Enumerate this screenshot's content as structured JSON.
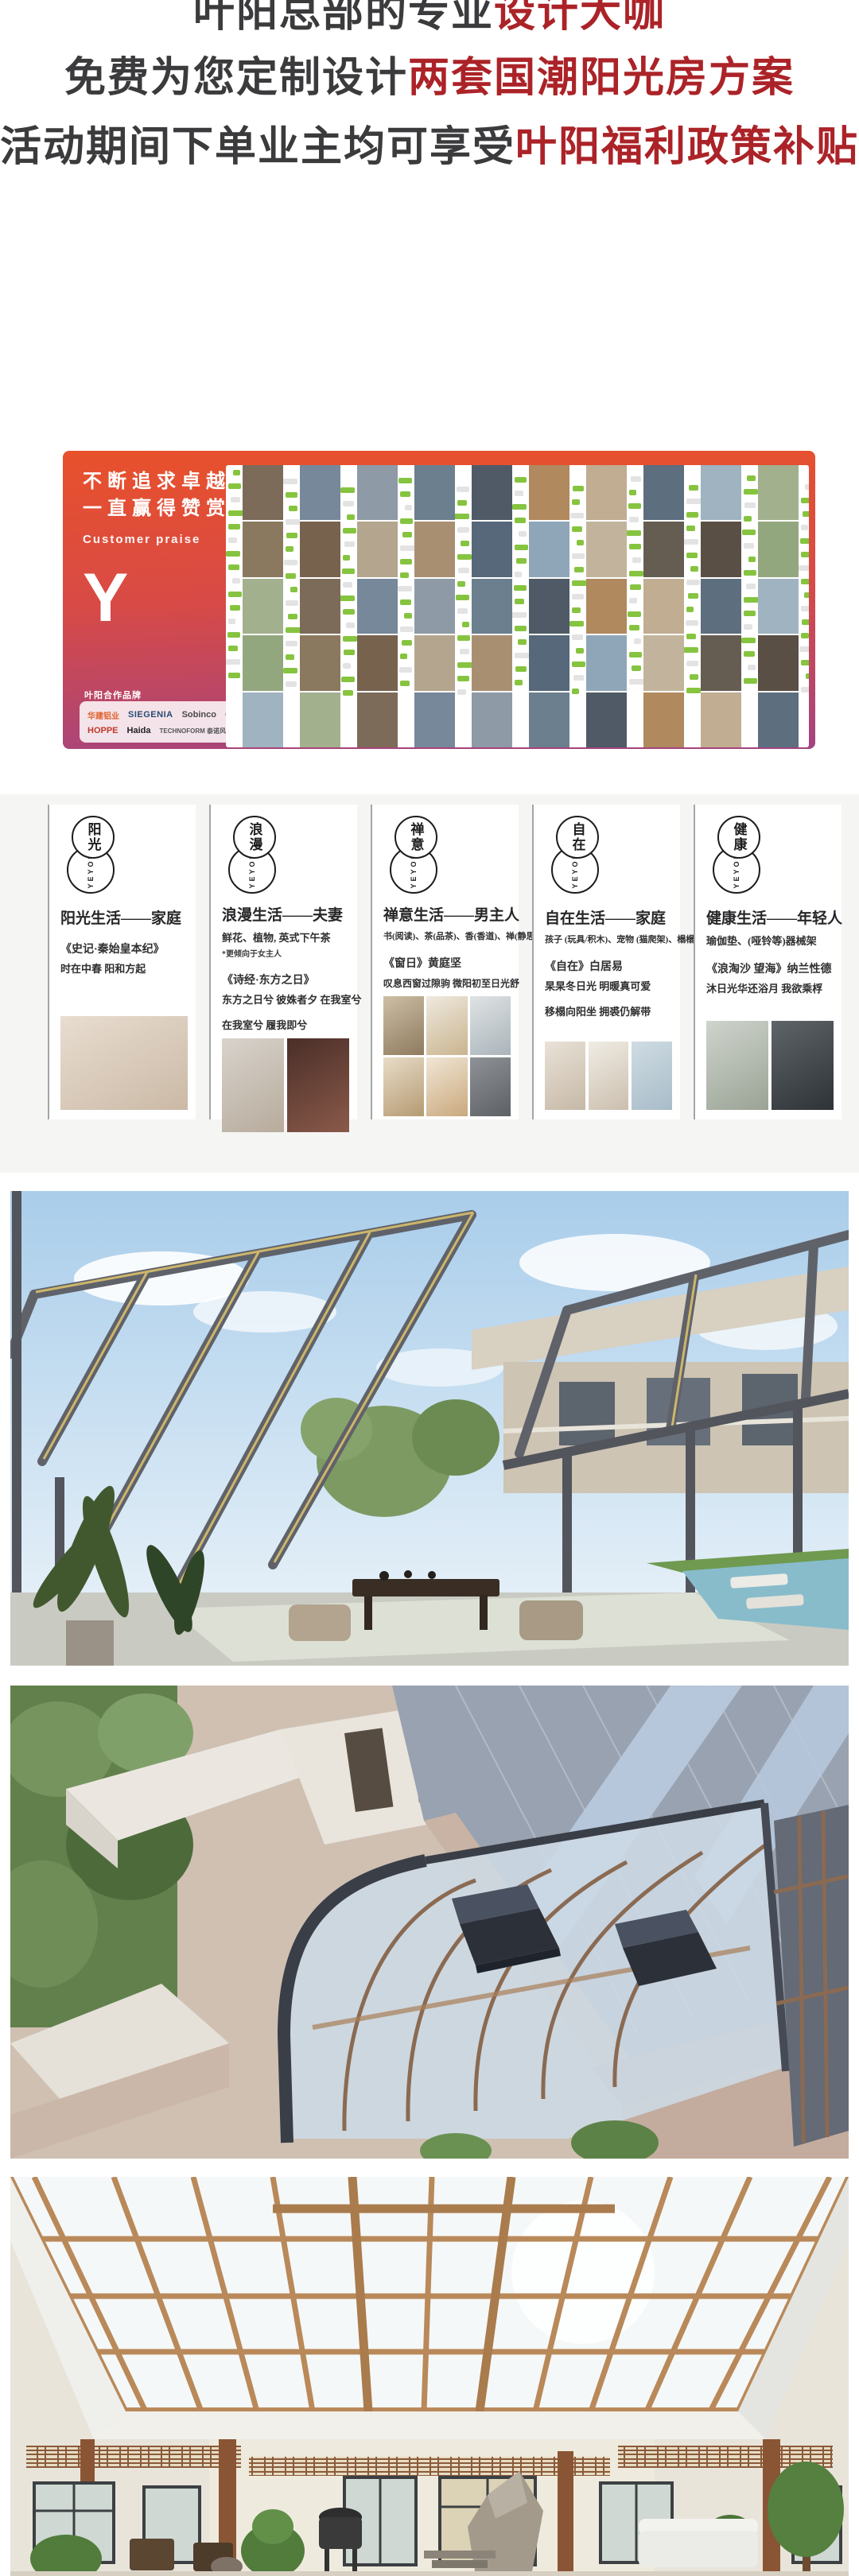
{
  "header": {
    "text_color": "#3b3b3d",
    "accent_color": "#ab2328",
    "lines": [
      {
        "black": "叶阳总部的专业",
        "red": "设计大咖"
      },
      {
        "black": "免费为您定制设计",
        "red": "两套国潮阳光房方案"
      },
      {
        "black": "活动期间下单业主均可享受",
        "red": "叶阳福利政策补贴"
      }
    ]
  },
  "banner": {
    "slogan_line1": "不断追求卓越",
    "slogan_line2": "一直赢得赞赏",
    "slogan_en": "Customer praise",
    "logo_letter": "Y",
    "partner_label": "叶阳合作品牌",
    "partner_brands": [
      "华建铝业",
      "SIEGENIA",
      "Sobinco",
      "CMECH",
      "HOPPE",
      "Haida",
      "TECHNOFORM 泰诺风"
    ],
    "gradient_top": "#e8512b",
    "gradient_bottom": "#a34480",
    "collage": {
      "columns": 21,
      "chat_rows": 16,
      "photo_rows": 5,
      "bubble_color": "#86c440",
      "tile_colors": [
        "#8fa6b8",
        "#6b7f8e",
        "#b4a58f",
        "#7d6b5a",
        "#93a77f",
        "#5d6e7e",
        "#c2b39c",
        "#4f5a66",
        "#a98f72",
        "#76889a",
        "#8a795f",
        "#9fb3c0",
        "#655d52",
        "#b0895e",
        "#56687a",
        "#8e9aa6",
        "#77624e",
        "#a3b08e",
        "#5a4f45",
        "#c0ad92"
      ]
    }
  },
  "cards": {
    "items": [
      {
        "logo_chars": "阳光",
        "logo_sub": "YEYON",
        "title": "阳光生活——家庭",
        "source": "《史记·秦始皇本纪》",
        "poem": [
          "时在中春 阳和方起"
        ],
        "photo_tiles": [
          [
            "#e8ddd0",
            "#cbb9a6"
          ]
        ]
      },
      {
        "logo_chars": "浪漫",
        "logo_sub": "YEYON",
        "title": "浪漫生活——夫妻",
        "subtitle": "鲜花、植物, 英式下午茶",
        "note": "*更倾向于女主人",
        "source": "《诗经·东方之日》",
        "poem": [
          "东方之日兮 彼姝者夕 在我室兮",
          "在我室兮 履我即兮"
        ],
        "photo_tiles": [
          [
            "#d8d3cc",
            "#b7ab9c"
          ],
          [
            "#4a2e28",
            "#8a5a4a"
          ]
        ]
      },
      {
        "logo_chars": "禅意",
        "logo_sub": "YEYON",
        "title": "禅意生活——男主人",
        "subtitle": "书(阅读)、茶(品茶)、香(香道)、禅(静思)",
        "source": "《窗日》黄庭坚",
        "poem": [
          "叹息西窗过隙驹 微阳初至日光舒"
        ],
        "photo_tiles": [
          [
            "#cdbfa5",
            "#8e7a5f"
          ],
          [
            "#efe9df",
            "#c9b48e"
          ],
          [
            "#dfe3e4",
            "#aab4ba"
          ],
          [
            "#e8dcc8",
            "#b59a72"
          ],
          [
            "#f0e6d6",
            "#caa87c"
          ],
          [
            "#8e9296",
            "#5d6166"
          ]
        ]
      },
      {
        "logo_chars": "自在",
        "logo_sub": "YEYON",
        "title": "自在生活——家庭",
        "subtitle": "孩子 (玩具/积木)、宠物 (猫爬架)、榻榻米",
        "source": "《自在》白居易",
        "poem": [
          "杲杲冬日光 明暖真可爱",
          "移榻向阳坐 拥裘仍解带"
        ],
        "photo_tiles": [
          [
            "#e9e2d8",
            "#c6b8a6"
          ],
          [
            "#f0ece4",
            "#cbbfae"
          ],
          [
            "#cfdce3",
            "#a8bcc8"
          ]
        ]
      },
      {
        "logo_chars": "健康",
        "logo_sub": "YEYON",
        "title": "健康生活——年轻人",
        "subtitle": "瑜伽垫、(哑铃等)器械架",
        "source": "《浪淘沙 望海》纳兰性德",
        "poem": [
          "沐日光华还浴月 我欲乘桴"
        ],
        "photo_tiles": [
          [
            "#cfd4cc",
            "#9aa396"
          ],
          [
            "#5e6468",
            "#2e3337"
          ]
        ]
      }
    ]
  },
  "photos": {
    "items": [
      {
        "alt": "国潮阳光房效果图：金属框架玻璃顶阳光房内景，茶桌座椅、绿植与庭院泳池"
      },
      {
        "alt": "国潮阳光房效果图：露台弧形玻璃顶阳光房鸟瞰，双开启天窗与灰瓦坡屋顶"
      },
      {
        "alt": "国潮阳光房效果图：中式庭院木结构玻璃天幕采光顶与回廊花格"
      }
    ]
  }
}
